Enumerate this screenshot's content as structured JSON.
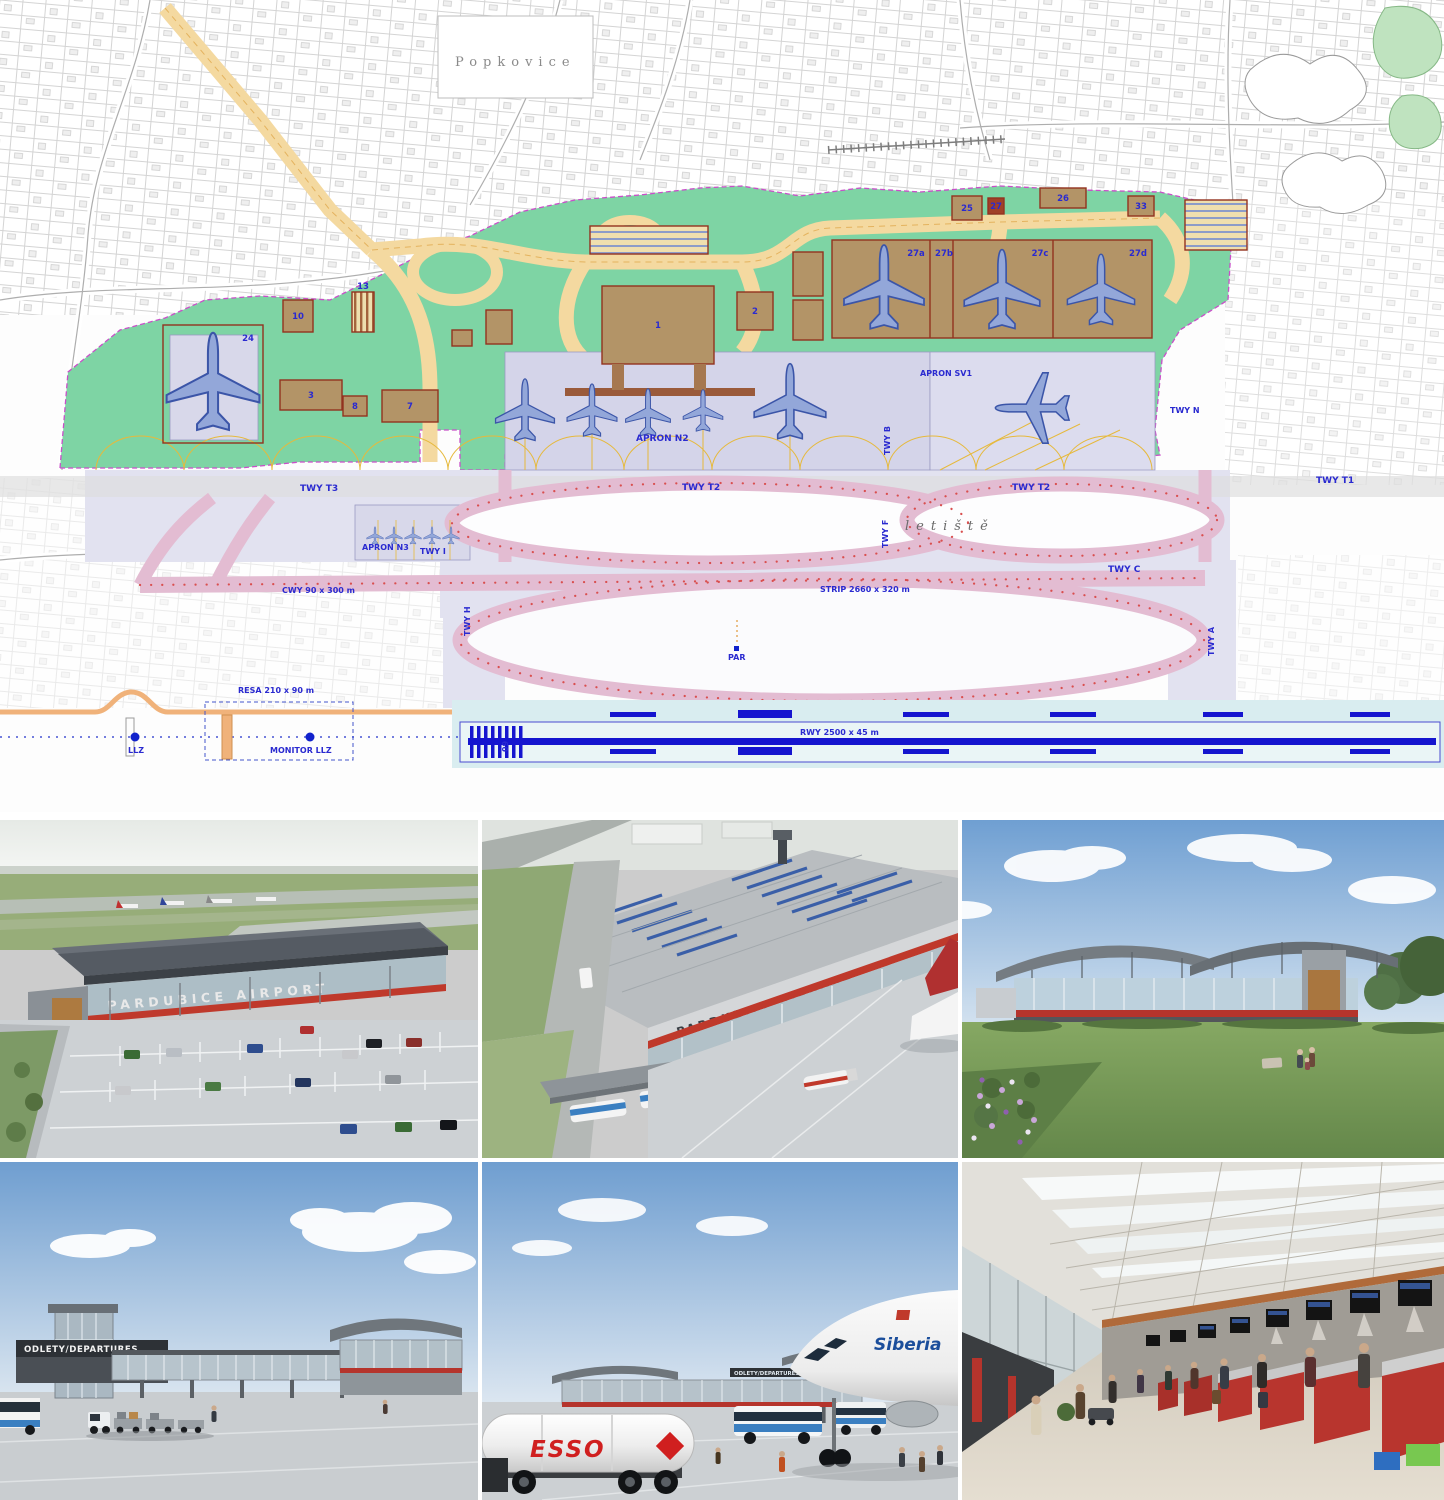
{
  "plan": {
    "area_label": "Popkovice",
    "handwriting_label": "letiště",
    "aprons": {
      "n2": "APRON N2",
      "n3": "APRON N3",
      "sv1": "APRON SV1"
    },
    "taxiways": {
      "t3": "TWY T3",
      "t2": "TWY T2",
      "t2e": "TWY T2",
      "t1": "TWY T1",
      "c": "TWY C",
      "f": "TWY F",
      "b": "TWY B",
      "n": "TWY N",
      "h": "TWY H",
      "i": "TWY I",
      "a": "TWY A"
    },
    "dimensions": {
      "cwy": "CWY 90 x 300 m",
      "strip": "STRIP 2660 x 320 m",
      "rwy": "RWY 2500 x 45 m",
      "resa": "RESA 210 x 90 m"
    },
    "nav": {
      "llz": "LLZ",
      "monitor_llz": "MONITOR LLZ",
      "par": "PAR",
      "rwy_designator": "09"
    },
    "buildings": {
      "terminal": "1",
      "b2": "2",
      "b3": "3",
      "b7": "7",
      "b8": "8",
      "b10": "10",
      "b13": "13",
      "hangar": "24",
      "b25": "25",
      "b26": "26",
      "b27": "27",
      "b33": "33"
    },
    "hangar_bays": {
      "a": "27a",
      "b": "27b",
      "c": "27c",
      "d": "27d"
    },
    "colors": {
      "airport_land": "#7ed4a4",
      "roads": "#f4d9a0",
      "buildings": "#b39467",
      "apron": "#d9d9ec",
      "taxiway_ring": "#e3bcd2",
      "runway_strip": "#d9edf0",
      "runway_marking": "#1515cf",
      "label_blue": "#2a2ad0"
    }
  },
  "renders": {
    "facade_sign": "PARDUBICE AIRPORT",
    "roof_sign": "PARDUBICE AIRPORT",
    "departures_sign": "ODLETY/DEPARTURES",
    "bridge_sign": "ODLETY/DEPARTURES",
    "fuel_brand": "ESSO",
    "airline": "Siberia"
  }
}
